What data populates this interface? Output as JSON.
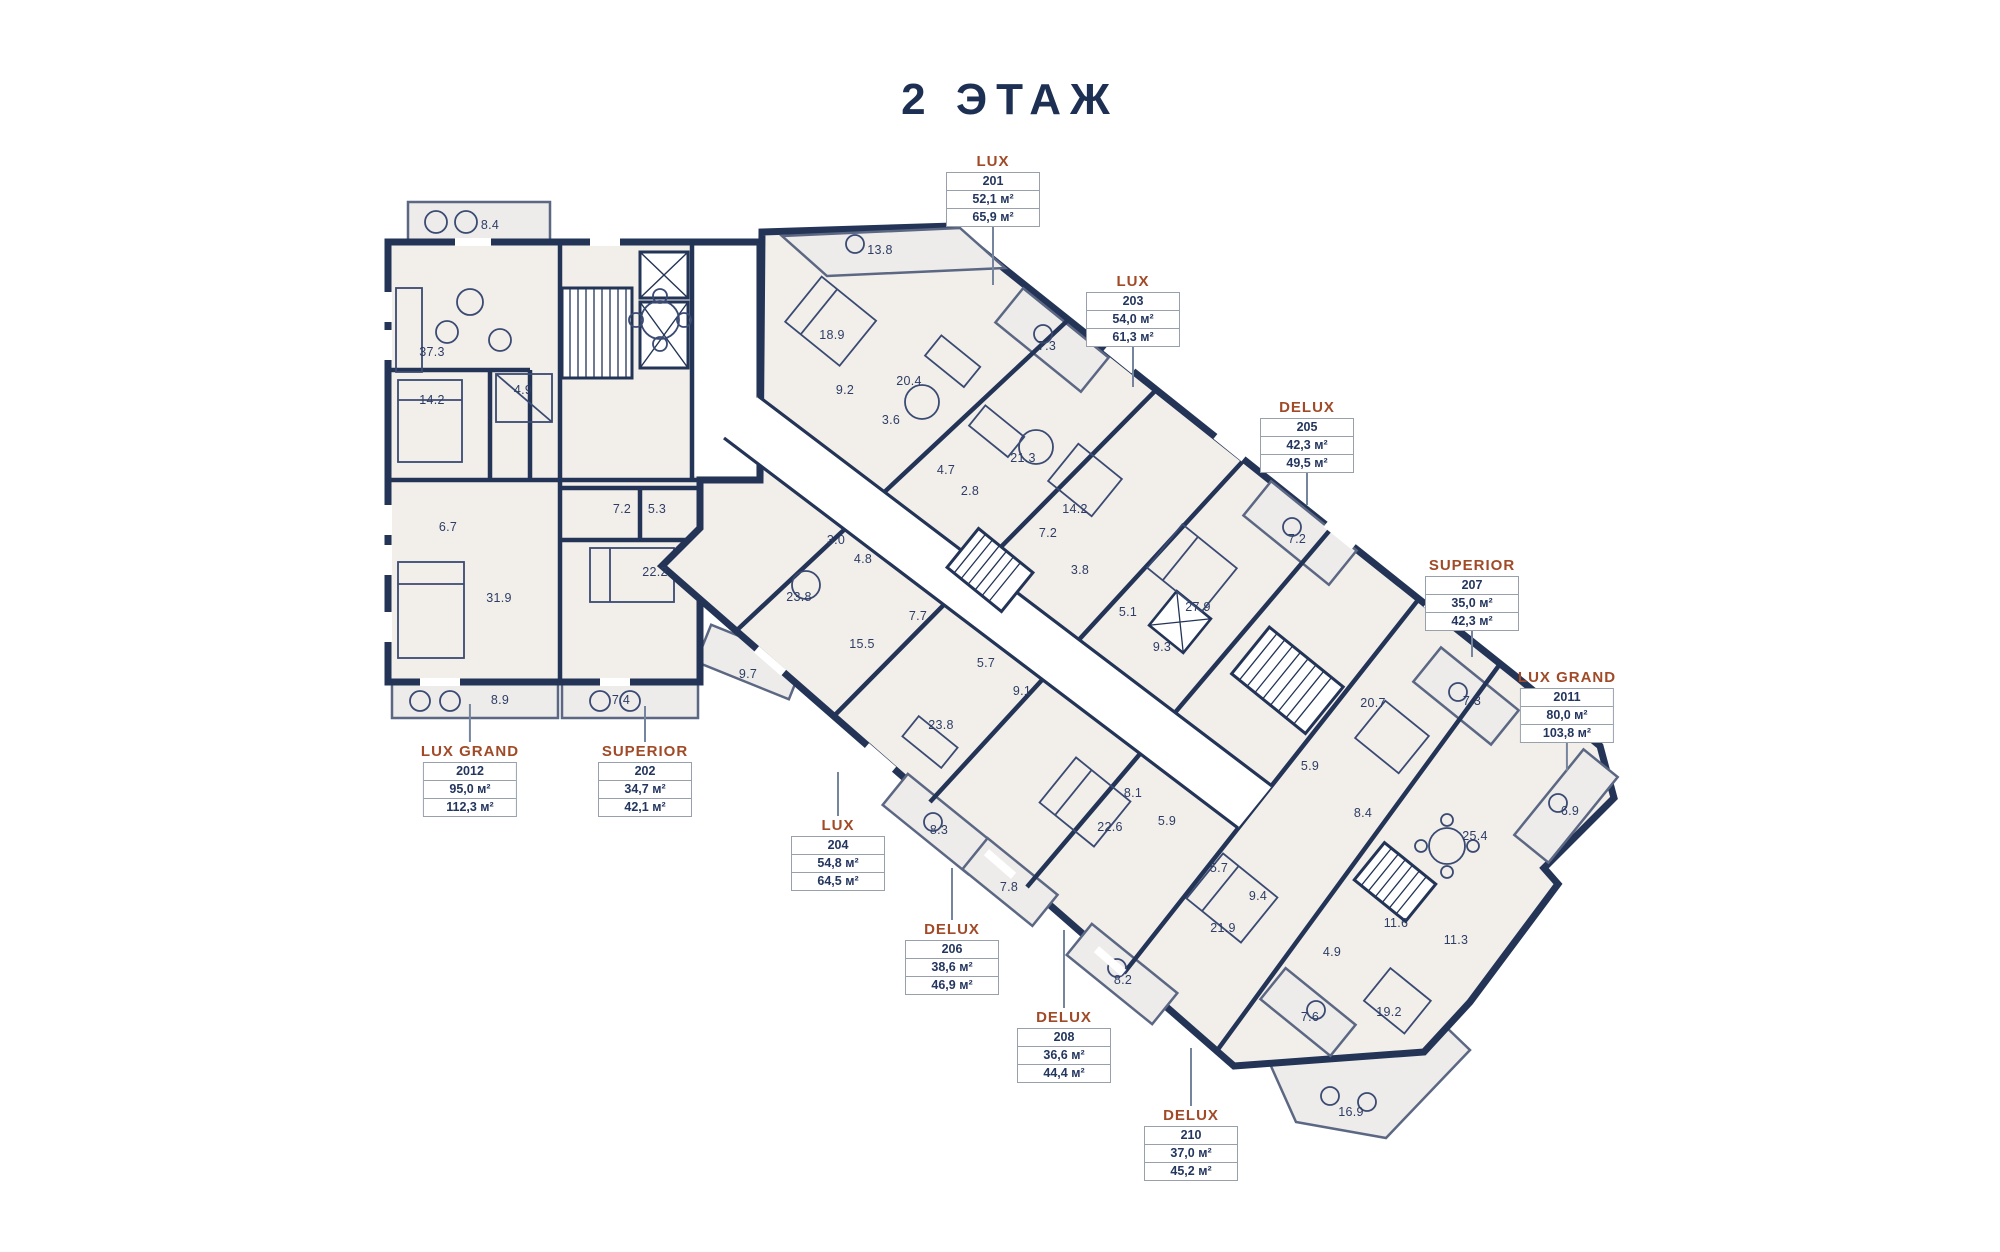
{
  "title": "2 ЭТАЖ",
  "colors": {
    "wall_navy": "#233457",
    "floor_fill": "#f2efeb",
    "balcony_fill": "#edecea",
    "accent_rust": "#a04a28",
    "label_navy": "#24365e",
    "leader_gray": "#76859e",
    "box_border_gray": "#98a0ac"
  },
  "units": [
    {
      "type": "LUX",
      "number": "201",
      "area_living": "52,1 м²",
      "area_total": "65,9 м²",
      "x": 993,
      "top": 152,
      "dir": "down",
      "lead": 58
    },
    {
      "type": "LUX",
      "number": "203",
      "area_living": "54,0 м²",
      "area_total": "61,3 м²",
      "x": 1133,
      "top": 272,
      "dir": "down",
      "lead": 40
    },
    {
      "type": "DELUX",
      "number": "205",
      "area_living": "42,3 м²",
      "area_total": "49,5 м²",
      "x": 1307,
      "top": 398,
      "dir": "down",
      "lead": 32
    },
    {
      "type": "SUPERIOR",
      "number": "207",
      "area_living": "35,0 м²",
      "area_total": "42,3 м²",
      "x": 1472,
      "top": 556,
      "dir": "down",
      "lead": 26
    },
    {
      "type": "LUX GRAND",
      "number": "2011",
      "area_living": "80,0 м²",
      "area_total": "103,8 м²",
      "x": 1567,
      "top": 668,
      "dir": "down",
      "lead": 28
    },
    {
      "type": "LUX GRAND",
      "number": "2012",
      "area_living": "95,0 м²",
      "area_total": "112,3 м²",
      "x": 470,
      "top": 704,
      "dir": "up",
      "lead": 38
    },
    {
      "type": "SUPERIOR",
      "number": "202",
      "area_living": "34,7 м²",
      "area_total": "42,1 м²",
      "x": 645,
      "top": 706,
      "dir": "up",
      "lead": 36
    },
    {
      "type": "LUX",
      "number": "204",
      "area_living": "54,8 м²",
      "area_total": "64,5 м²",
      "x": 838,
      "top": 772,
      "dir": "up",
      "lead": 44
    },
    {
      "type": "DELUX",
      "number": "206",
      "area_living": "38,6 м²",
      "area_total": "46,9 м²",
      "x": 952,
      "top": 868,
      "dir": "up",
      "lead": 52
    },
    {
      "type": "DELUX",
      "number": "208",
      "area_living": "36,6 м²",
      "area_total": "44,4 м²",
      "x": 1064,
      "top": 930,
      "dir": "up",
      "lead": 78
    },
    {
      "type": "DELUX",
      "number": "210",
      "area_living": "37,0 м²",
      "area_total": "45,2 м²",
      "x": 1191,
      "top": 1048,
      "dir": "up",
      "lead": 58
    }
  ],
  "rooms": [
    {
      "x": 490,
      "y": 225,
      "v": "8.4"
    },
    {
      "x": 432,
      "y": 352,
      "v": "37.3"
    },
    {
      "x": 432,
      "y": 400,
      "v": "14.2"
    },
    {
      "x": 523,
      "y": 390,
      "v": "4.9"
    },
    {
      "x": 448,
      "y": 527,
      "v": "6.7"
    },
    {
      "x": 499,
      "y": 598,
      "v": "31.9"
    },
    {
      "x": 622,
      "y": 509,
      "v": "7.2"
    },
    {
      "x": 657,
      "y": 509,
      "v": "5.3"
    },
    {
      "x": 655,
      "y": 572,
      "v": "22.2"
    },
    {
      "x": 500,
      "y": 700,
      "v": "8.9"
    },
    {
      "x": 621,
      "y": 700,
      "v": "7.4"
    },
    {
      "x": 748,
      "y": 674,
      "v": "9.7"
    },
    {
      "x": 880,
      "y": 250,
      "v": "13.8"
    },
    {
      "x": 832,
      "y": 335,
      "v": "18.9"
    },
    {
      "x": 845,
      "y": 390,
      "v": "9.2"
    },
    {
      "x": 909,
      "y": 381,
      "v": "20.4"
    },
    {
      "x": 891,
      "y": 420,
      "v": "3.6"
    },
    {
      "x": 1047,
      "y": 346,
      "v": "7.3"
    },
    {
      "x": 1023,
      "y": 458,
      "v": "21.3"
    },
    {
      "x": 946,
      "y": 470,
      "v": "4.7"
    },
    {
      "x": 970,
      "y": 491,
      "v": "2.8"
    },
    {
      "x": 1075,
      "y": 509,
      "v": "14.2"
    },
    {
      "x": 1048,
      "y": 533,
      "v": "7.2"
    },
    {
      "x": 1080,
      "y": 570,
      "v": "3.8"
    },
    {
      "x": 836,
      "y": 540,
      "v": "3.0"
    },
    {
      "x": 863,
      "y": 559,
      "v": "4.8"
    },
    {
      "x": 799,
      "y": 597,
      "v": "23.8"
    },
    {
      "x": 918,
      "y": 616,
      "v": "7.7"
    },
    {
      "x": 1128,
      "y": 612,
      "v": "5.1"
    },
    {
      "x": 862,
      "y": 644,
      "v": "15.5"
    },
    {
      "x": 986,
      "y": 663,
      "v": "5.7"
    },
    {
      "x": 1022,
      "y": 691,
      "v": "9.1"
    },
    {
      "x": 941,
      "y": 725,
      "v": "23.8"
    },
    {
      "x": 1198,
      "y": 607,
      "v": "27.9"
    },
    {
      "x": 1162,
      "y": 647,
      "v": "9.3"
    },
    {
      "x": 1297,
      "y": 539,
      "v": "7.2"
    },
    {
      "x": 1373,
      "y": 703,
      "v": "20.7"
    },
    {
      "x": 1472,
      "y": 701,
      "v": "7.3"
    },
    {
      "x": 1310,
      "y": 766,
      "v": "5.9"
    },
    {
      "x": 1167,
      "y": 821,
      "v": "5.9"
    },
    {
      "x": 1363,
      "y": 813,
      "v": "8.4"
    },
    {
      "x": 1133,
      "y": 793,
      "v": "8.1"
    },
    {
      "x": 1110,
      "y": 827,
      "v": "22.6"
    },
    {
      "x": 1219,
      "y": 868,
      "v": "5.7"
    },
    {
      "x": 1258,
      "y": 896,
      "v": "9.4"
    },
    {
      "x": 1223,
      "y": 928,
      "v": "21.9"
    },
    {
      "x": 1332,
      "y": 952,
      "v": "4.9"
    },
    {
      "x": 1396,
      "y": 923,
      "v": "11.6"
    },
    {
      "x": 939,
      "y": 830,
      "v": "8.3"
    },
    {
      "x": 1009,
      "y": 887,
      "v": "7.8"
    },
    {
      "x": 1123,
      "y": 980,
      "v": "8.2"
    },
    {
      "x": 1310,
      "y": 1017,
      "v": "7.6"
    },
    {
      "x": 1389,
      "y": 1012,
      "v": "19.2"
    },
    {
      "x": 1475,
      "y": 836,
      "v": "25.4"
    },
    {
      "x": 1570,
      "y": 811,
      "v": "6.9"
    },
    {
      "x": 1456,
      "y": 940,
      "v": "11.3"
    },
    {
      "x": 1351,
      "y": 1112,
      "v": "16.9"
    }
  ]
}
